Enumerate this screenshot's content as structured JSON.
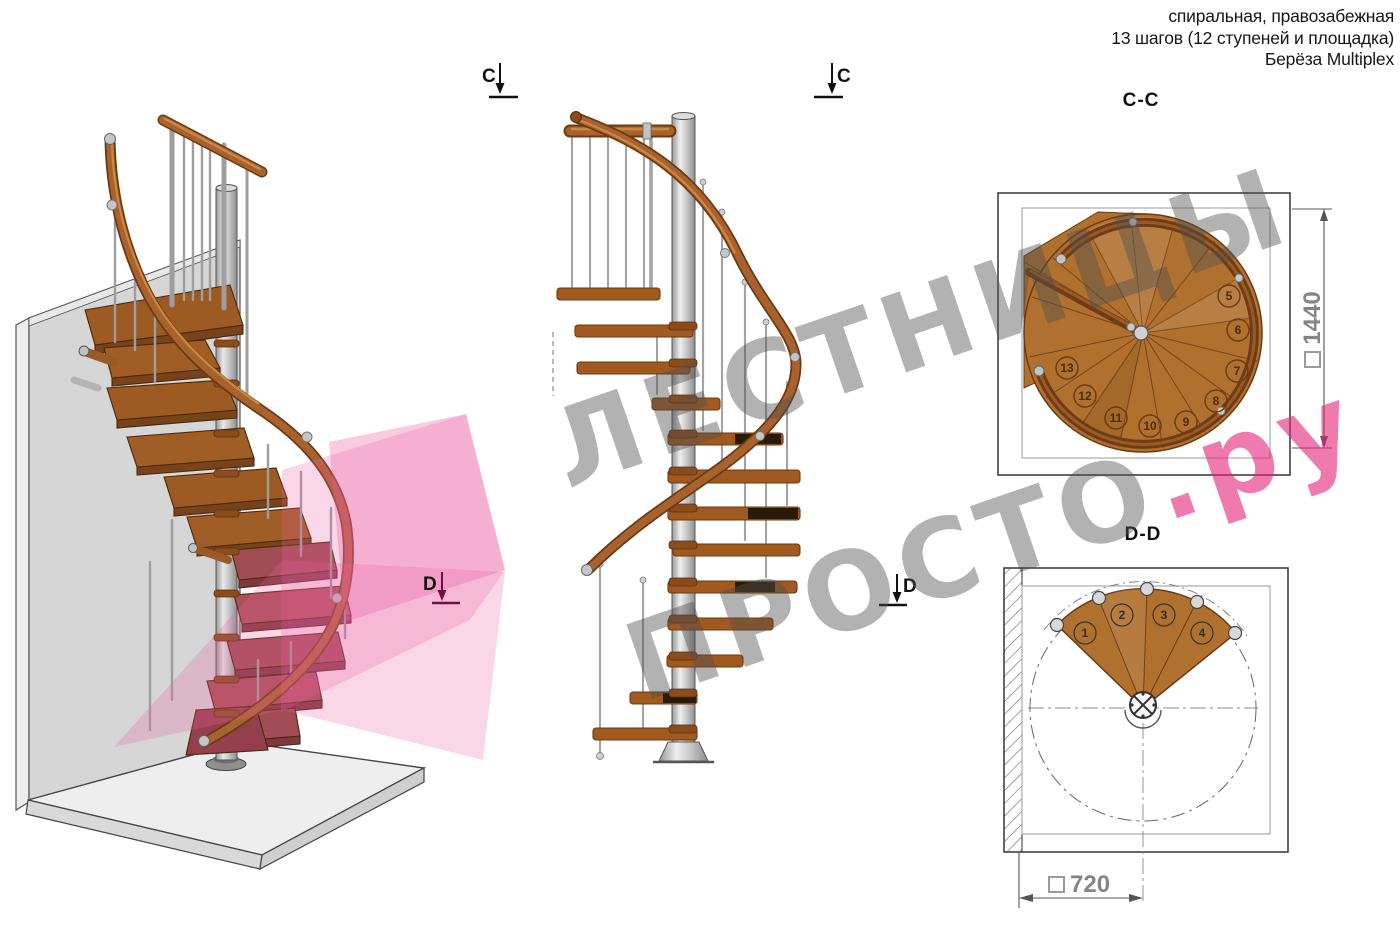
{
  "header": {
    "line1": "спиральная, правозабежная",
    "line2": "13 шагов (12 ступеней и площадка)",
    "line3": "Берёза Multiplex"
  },
  "section_labels": {
    "cc": "C-C",
    "dd": "D-D"
  },
  "markers": {
    "c": "C",
    "d": "D"
  },
  "dimensions": {
    "square": "□",
    "cc_value": "1440",
    "dd_value": "720"
  },
  "plan_cc": {
    "step_numbers": [
      "5",
      "6",
      "7",
      "8",
      "9",
      "10",
      "11",
      "12",
      "13"
    ]
  },
  "plan_dd": {
    "step_numbers": [
      "1",
      "2",
      "3",
      "4"
    ]
  },
  "watermark": {
    "line1": "ЛЕСТНИЦЫ",
    "line2_gray": "ПРОСТО",
    "line2_pink": ".ру"
  },
  "colors": {
    "wood": "#a8622e",
    "wood_dark": "#6b3a12",
    "metal": "#c9c9c9",
    "section_plane_pink": "#ec5fa1",
    "cut_steps_maroon": "#a14c55",
    "watermark_gray": "#787878",
    "watermark_pink": "#e22278",
    "dimension_text": "#858585"
  }
}
